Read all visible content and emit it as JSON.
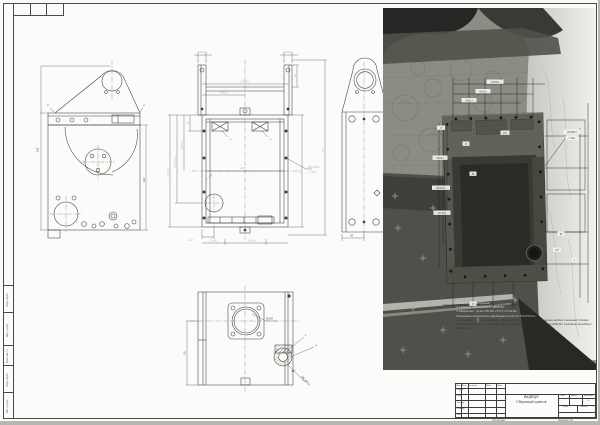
{
  "frame": {
    "kopiroval": "Копировал",
    "format": "Формат A3",
    "margin_labels": [
      "Подп. и дата",
      "Инв. № дубл.",
      "Взам. инв. №",
      "Подп. и дата",
      "Инв. № подл."
    ]
  },
  "title_block": {
    "header_cols": [
      "Изм.",
      "Лист",
      "№ докум.",
      "Подп.",
      "Дата"
    ],
    "roles": [
      "Разраб.",
      "Пров.",
      "Т.контр.",
      "Н.контр.",
      "Утв."
    ],
    "product_name": "Корпус",
    "doc_type": "Сборочный чертеж",
    "lit_label": "Лит.",
    "mass_label": "Масса",
    "scale_label": "Масштаб",
    "scale_value": "1:2",
    "sheet_label": "Лист",
    "sheets_label": "Листов",
    "sheets_value": "1"
  },
  "notes": {
    "lines": [
      "1. *Размеры для справок.",
      "2. Сварные швы по ГОСТ 14806-80.",
      "3. Покрытие: грунт ГФ-021 ГОСТ 25129-82.",
      "Остальные технические требования по ОСТ4 ГО.070.014.",
      "4. Закладные шайбы приварить, приварку вести от большей толщины листов к меньшей стенке.",
      "5. Клей 88-Н ОСТ 6-15-2785-83. Грибки вытяжные поз. 7 клеить клеем 88-Н к пластине (вклейке) с корпусом."
    ]
  },
  "views": {
    "front": {
      "dims": {
        "height": "245",
        "width_right": "160",
        "chamfer_l": "2",
        "chamfer_r": "2"
      }
    },
    "main": {
      "dims": {
        "post_l": "20±0,1",
        "span": "120±0,1",
        "half": "63±0,1",
        "post_r": "20±0,1",
        "depth": "36",
        "l1": "27",
        "l2": "50±0,2",
        "l3": "89,5±0,2",
        "l4": "111±0,2",
        "bl": "44,5",
        "b1": "23±0,2",
        "b2": "66±0,2",
        "mid": "110",
        "g1": "42",
        "g2": "42",
        "t2": "2",
        "r1": "112",
        "r2": "177",
        "hole1": "Ø6,3Н12",
        "hole2": "7 отв."
      }
    },
    "side": {
      "dims": {
        "w": "35"
      }
    },
    "bottom": {
      "dims": {
        "h": "90",
        "flange": "Ø105",
        "pos1": "1",
        "pos4": "4",
        "ang": "45°",
        "hole": "Ø6,3Н12"
      }
    }
  },
  "photo": {
    "labels": [
      "120±0,1",
      "63±0,1",
      "20±0,1",
      "27",
      "50±0,2",
      "89,5±0,2",
      "111±0,2",
      "23",
      "66",
      "110",
      "Ø6,3Н12",
      "7 отв.",
      "90",
      "45°",
      "4",
      "35"
    ]
  }
}
